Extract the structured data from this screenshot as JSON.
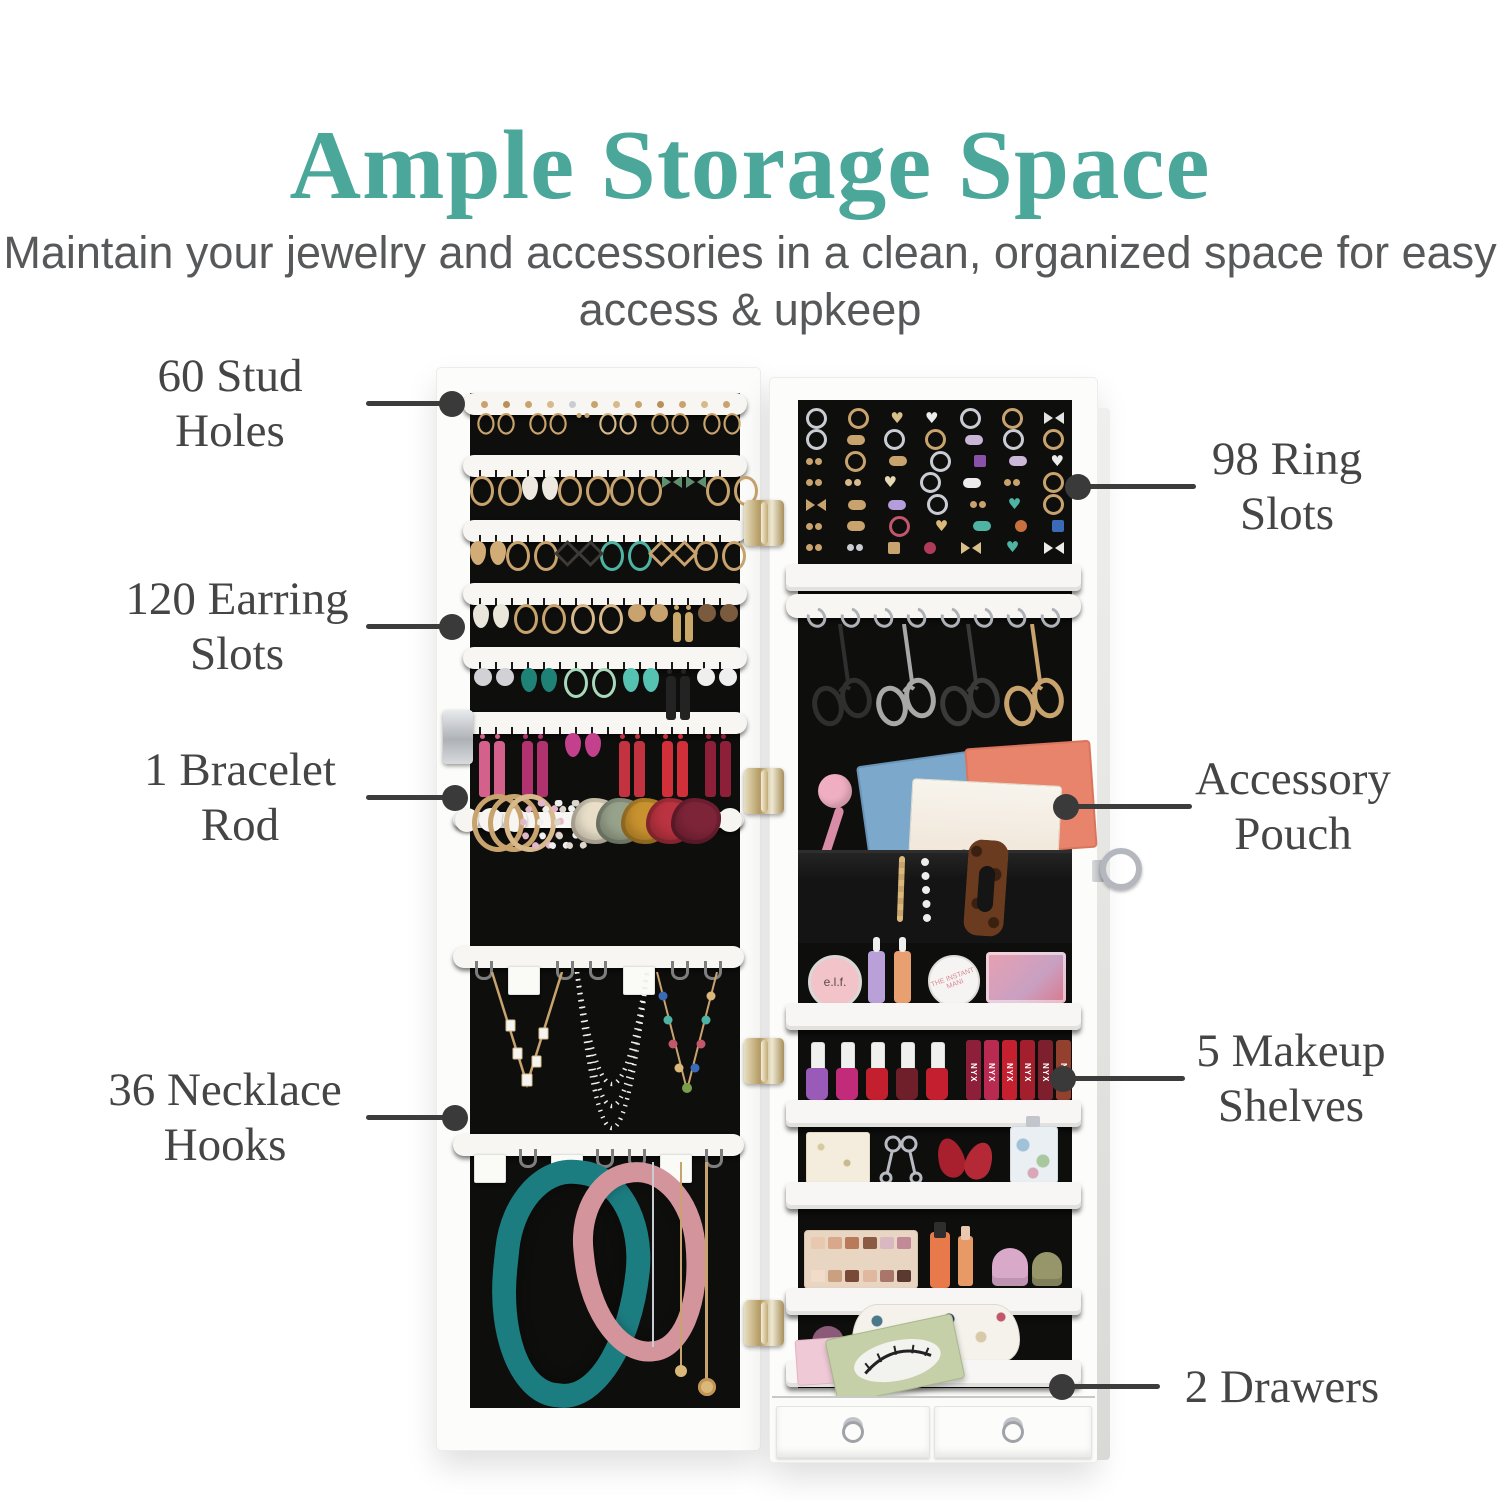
{
  "header": {
    "title": "Ample Storage Space",
    "subtitle_line1": "Maintain your jewelry and accessories in a clean,",
    "subtitle_line2": "organized space for easy access & upkeep"
  },
  "colors": {
    "accent_teal": "#4AA79A",
    "subtitle_gray": "#57585A",
    "callout_text": "#454545",
    "leader_line": "#3C3C3C",
    "cabinet_white": "#FCFCFA",
    "interior_black": "#0E0E0D"
  },
  "callouts": [
    {
      "id": "stud-holes",
      "line1": "60 Stud",
      "line2": "Holes"
    },
    {
      "id": "earring-slots",
      "line1": "120 Earring",
      "line2": "Slots"
    },
    {
      "id": "bracelet-rod",
      "line1": "1 Bracelet",
      "line2": "Rod"
    },
    {
      "id": "necklace-hooks",
      "line1": "36 Necklace",
      "line2": "Hooks"
    },
    {
      "id": "ring-slots",
      "line1": "98 Ring",
      "line2": "Slots"
    },
    {
      "id": "accessory-pouch",
      "line1": "Accessory",
      "line2": "Pouch"
    },
    {
      "id": "makeup-shelves",
      "line1": "5 Makeup",
      "line2": "Shelves"
    },
    {
      "id": "drawers",
      "line1": "2 Drawers",
      "line2": ""
    }
  ],
  "illustration": {
    "labels": {
      "blush": "e.l.f.",
      "lipstick_brand": "NYX",
      "packet_brand": "avatara",
      "mani_tin": "THE INSTANT MANI"
    },
    "stud_row": [
      "#C9A36E",
      "#B98F5A",
      "#C9A36E",
      "#D8B98C",
      "#C9CCD2",
      "#C9A36E",
      "#D8B98C",
      "#C9A36E",
      "#B98F5A",
      "#C9A36E",
      "#D8B98C",
      "#C9A36E"
    ],
    "earring_rows": [
      [
        "hoop:#C9A36E",
        "hoop:#C9A36E",
        "stud:#C9A36E",
        "hoop:#D8B98C",
        "hoop:#C9A36E",
        "hoop:#C9A36E"
      ],
      [
        "hoop:#C9A36E",
        "drop:#EDE9E0",
        "hoop:#C9A36E",
        "hoop:#C9A36E",
        "bow:#5F8F6D",
        "hoop:#C9A36E"
      ],
      [
        "drop:#D2AC77",
        "hoop:#C9A36E",
        "diamond:#3E3A36",
        "hoop:#4FB3A4",
        "diamond:#C9A36E",
        "hoop:#C9A36E"
      ],
      [
        "drop:#EAE6DC",
        "hoop:#C9A36E",
        "hoop:#D8B98C",
        "disc:#C9A36E",
        "tassel:#C9A86A",
        "disc:#7A5B3E"
      ],
      [
        "disc:#D2D2D6",
        "drop:#1F8276",
        "hoop:#A9D9BB",
        "drop:#56C2B2",
        "tassel:#232323",
        "disc:#EFEFEF"
      ],
      [
        "tassel:#D4608C",
        "tassel:#B0326E",
        "drop:#C2408C",
        "tassel:#C2333F",
        "tassel:#D12F3A",
        "tassel:#8E1F38"
      ]
    ],
    "ring_rows": [
      [
        "ring:#C9CCD2",
        "ring:#C9A36E",
        "heart:#D9C08A",
        "heart:#ECECEC",
        "ring:#C9CCD2",
        "ring:#C9A36E",
        "bow:#E3E3E3"
      ],
      [
        "ring:#C9CCD2",
        "pill:#C9A36E",
        "ring:#C9CCD2",
        "ring:#C9A36E",
        "pill:#C9B5D6",
        "ring:#C9CCD2",
        "ring:#C9A36E"
      ],
      [
        "studs:#C9A36E",
        "ring:#C9A36E",
        "pill:#C9A36E",
        "ring:#C9CCD2",
        "sq:#8952A8",
        "pill:#CBB7D8",
        "heart:#ECECEC"
      ],
      [
        "studs:#C9A36E",
        "studs:#D8B98C",
        "heart:#E6D9B5",
        "ring:#C9CCD2",
        "pill:#ECECEC",
        "studs:#C9A36E",
        "ring:#C9A36E"
      ],
      [
        "bow:#C9A36E",
        "pill:#C9A36E",
        "pill:#B39DDB",
        "ring:#C9CCD2",
        "studs:#C9A36E",
        "heart:#4FB3A4",
        "ring:#C9A36E"
      ],
      [
        "studs:#C9A36E",
        "pill:#C9A36E",
        "ring:#C2566B",
        "heart:#D9B87A",
        "pill:#4FB3A4",
        "dot:#C9703F",
        "sq:#3A6AB8"
      ],
      [
        "studs:#C9A36E",
        "studs:#C9CCD2",
        "sq:#C9A36E",
        "dot:#B03A5A",
        "bow:#D9C08A",
        "heart:#4FB3A4",
        "bow:#ECECEC"
      ]
    ],
    "hook_count": 8,
    "necklace_bars": {
      "a": [
        "hook",
        "tag",
        "hook",
        "hook",
        "tag",
        "hook",
        "hook"
      ],
      "b": [
        "tag",
        "hook",
        "tag",
        "hook",
        "hook",
        "tag",
        "hook"
      ]
    },
    "sunglasses": [
      "#2F2F2F",
      "#A8A8A8",
      "#3A3A3A",
      "#C9A36E"
    ],
    "bracelets": [
      "bangle:#C9A36E",
      "bangle:#C9A36E",
      "bangle:#D8B98C",
      "beadb:#E3B7C9",
      "beadb:#EFEFEF",
      "beadb:#DDD6CC",
      "scrunchie:#E9DFC9",
      "scrunchie:#97A28B",
      "scrunchie:#C8922E",
      "scrunchie:#BA3340",
      "scrunchie:#7E2438"
    ],
    "polishes": [
      "#9A5AB8",
      "#C22A7A",
      "#C41F2E",
      "#6E1F2A",
      "#C41F2E"
    ],
    "lipsticks": [
      "#8E1F3A",
      "#B82A50",
      "#C42030",
      "#A31F2E",
      "#7E1F2E",
      "#93402F"
    ],
    "eyeshadow": [
      "#E8C9B0",
      "#D9A88A",
      "#B87A5A",
      "#8A5A42",
      "#D9B8C2",
      "#C28A96",
      "#F2DCC9",
      "#C9A080",
      "#7A4A38",
      "#E0B8A0",
      "#A8766B",
      "#5A3A30"
    ]
  }
}
